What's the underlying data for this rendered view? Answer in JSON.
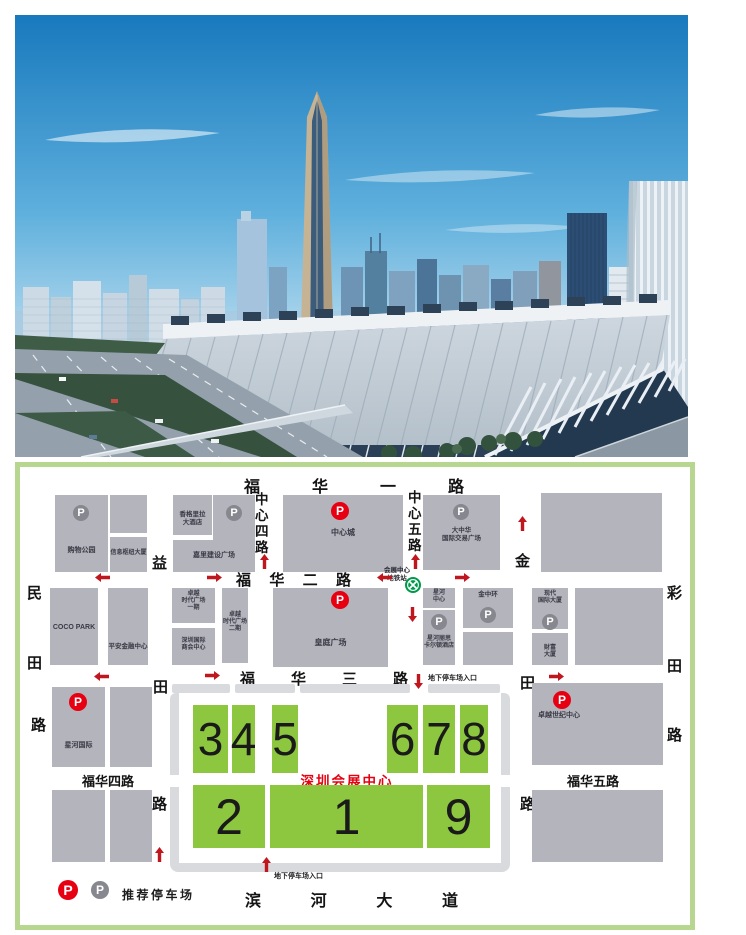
{
  "map": {
    "title": "深圳会展中心",
    "legend_label": "推荐停车场",
    "metro_station": "会展中心\n地铁站",
    "parking_entrance": "地下停车场入口",
    "halls": [
      "3",
      "4",
      "5",
      "6",
      "7",
      "8",
      "2",
      "1",
      "9"
    ],
    "streets": {
      "fuhua1": [
        "福",
        "华",
        "一",
        "路"
      ],
      "fuhua2": [
        "福",
        "华",
        "二",
        "路"
      ],
      "fuhua3": [
        "福",
        "华",
        "三",
        "路"
      ],
      "fuhua4": "福华四路",
      "fuhua5": "福华五路",
      "binhe": [
        "滨",
        "河",
        "大",
        "道"
      ],
      "zhongxin4": [
        "中",
        "心",
        "四",
        "路"
      ],
      "zhongxin5": [
        "中",
        "心",
        "五",
        "路"
      ],
      "mintian": [
        "民",
        "田",
        "路"
      ],
      "yitian": [
        "益",
        "田",
        "路"
      ],
      "jintian": [
        "金",
        "田",
        "路"
      ],
      "caitian": [
        "彩",
        "田",
        "路"
      ]
    },
    "buildings": {
      "shopping_park": "购物公园",
      "info_hub": "信息枢纽大厦",
      "shangri_la": "香格里拉\n大酒店",
      "kerry_plaza": "嘉里建设广场",
      "central_city": "中心城",
      "greater_china": "大中华\n国际交易广场",
      "coco_park": "COCO PARK",
      "pingan_finance": "平安金融中心",
      "excellence_times_1": "卓越\n时代广场\n一期",
      "chamber_commerce": "深圳国际\n商会中心",
      "excellence_times_2": "卓越\n时代广场\n二期",
      "huangting_plaza": "皇庭广场",
      "galaxy_center": "星河\n中心",
      "ritz_carlton": "星河丽思\n卡尔顿酒店",
      "jinzhonghuan": "金中环",
      "modern_intl": "现代\n国际大厦",
      "fortune_tower": "财富\n大厦",
      "galaxy_intl": "星河国际",
      "excellence_century": "卓越世纪中心"
    },
    "icons": {
      "parking_letter": "P"
    },
    "colors": {
      "hall_green": "#8dc63f",
      "parking_red": "#e60012",
      "parking_gray": "#87878f",
      "metro_green": "#00984a",
      "arrow_red": "#c0161d",
      "title_red": "#e60012",
      "block_gray": "#b4b4bc",
      "border_green": "#b7d690"
    }
  }
}
